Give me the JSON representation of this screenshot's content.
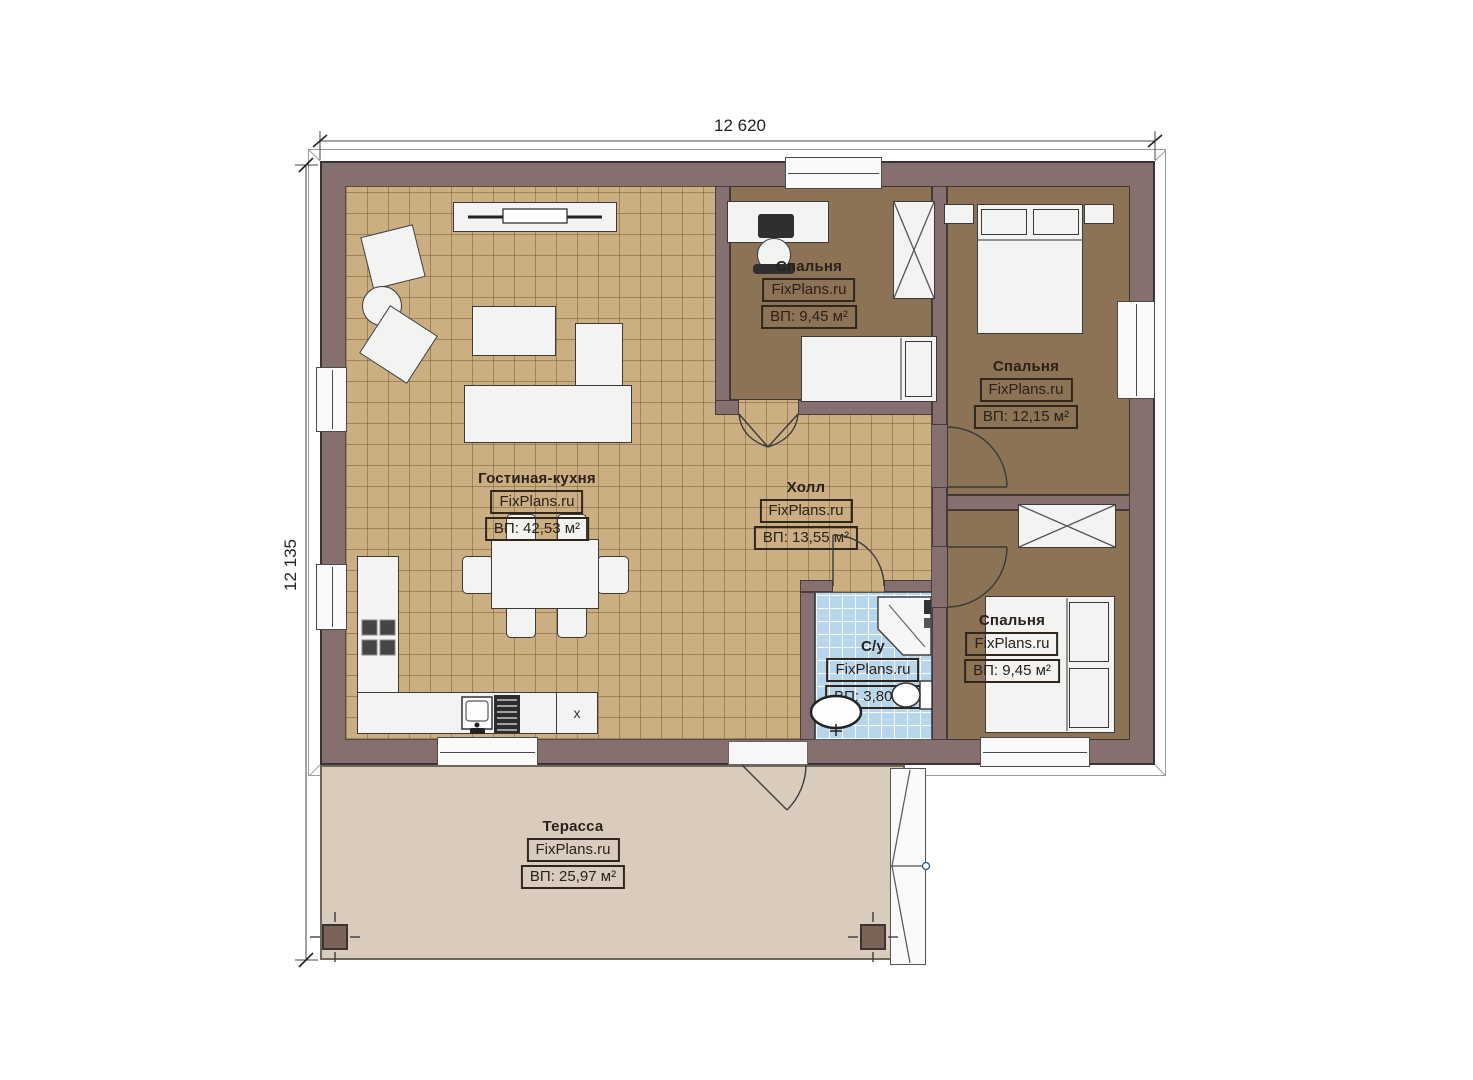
{
  "plan": {
    "watermark": "FixPlans.ru",
    "dimensions": {
      "width": "12 620",
      "height": "12 135"
    },
    "rooms": [
      {
        "key": "living-kitchen",
        "name": "Гостиная-кухня",
        "area": "ВП: 42,53 м²"
      },
      {
        "key": "bedroom-top",
        "name": "Спальня",
        "area": "ВП: 9,45 м²"
      },
      {
        "key": "bedroom-right",
        "name": "Спальня",
        "area": "ВП: 12,15 м²"
      },
      {
        "key": "hall",
        "name": "Холл",
        "area": "ВП: 13,55 м²"
      },
      {
        "key": "bathroom",
        "name": "С/у",
        "area": "ВП: 3,80 м²"
      },
      {
        "key": "bedroom-bottom",
        "name": "Спальня",
        "area": "ВП: 9,45 м²"
      },
      {
        "key": "terrace",
        "name": "Терасса",
        "area": "ВП: 25,97 м²"
      }
    ],
    "kitchen": {
      "appliance_label": "x"
    },
    "colors": {
      "wall": "#856f6f",
      "tile_floor": "#cbaf83",
      "bedroom_floor": "#8c7356",
      "bathroom_floor": "#b7d6ec",
      "terrace_floor": "#d9ccbd"
    }
  }
}
